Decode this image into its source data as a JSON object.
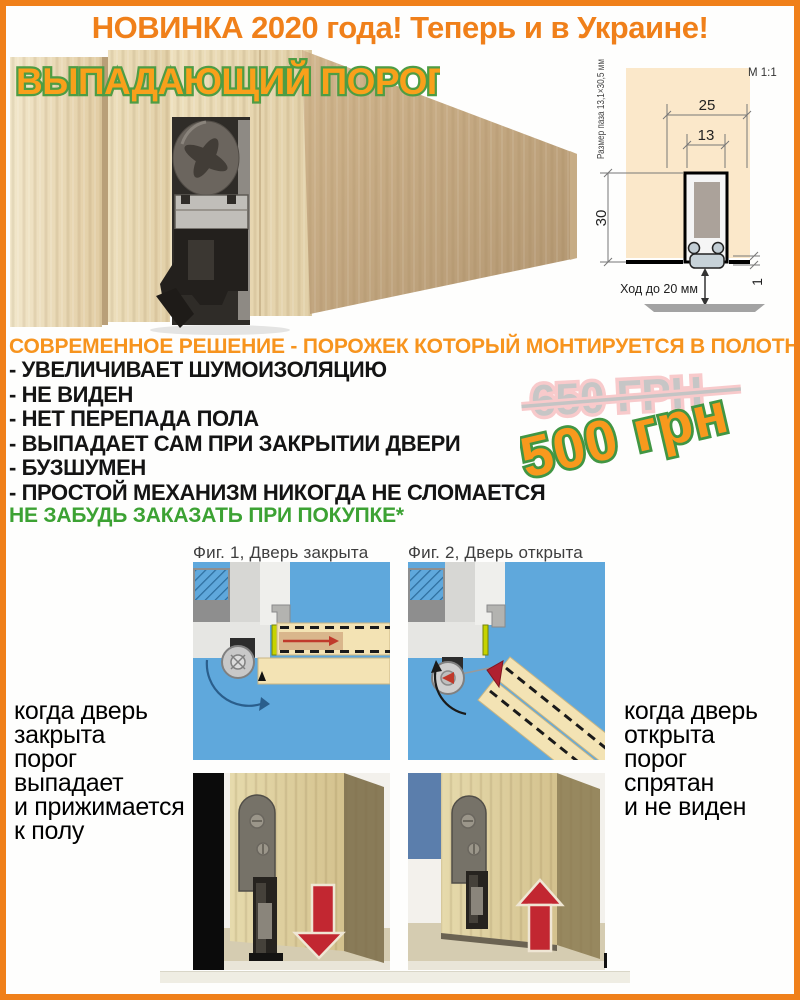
{
  "banner": {
    "text": "НОВИНКА 2020 года! Теперь и в Украине!"
  },
  "product": {
    "title": "ВЫПАДАЮЩИЙ ПОРОГ"
  },
  "diagram": {
    "scale": "М 1:1",
    "groove_size": "Размер паза 13,1×30,5 мм",
    "width_outer_mm": "25",
    "width_inner_mm": "13",
    "height_mm": "30",
    "gap_mm": "1",
    "travel": "Ход до 20 мм"
  },
  "promo": {
    "headline": "СОВРЕМЕННОЕ РЕШЕНИЕ - ПОРОЖЕК КОТОРЫЙ МОНТИРУЕТСЯ В ПОЛОТНО!",
    "features": [
      "- УВЕЛИЧИВАЕТ ШУМОИЗОЛЯЦИЮ",
      "- НЕ ВИДЕН",
      "- НЕТ ПЕРЕПАДА ПОЛА",
      "- ВЫПАДАЕТ САМ ПРИ ЗАКРЫТИИ ДВЕРИ",
      "- БУЗШУМЕН",
      "- ПРОСТОЙ МЕХАНИЗМ НИКОГДА НЕ СЛОМАЕТСЯ"
    ],
    "reminder": "НЕ ЗАБУДЬ ЗАКАЗАТЬ ПРИ ПОКУПКЕ*",
    "price_old": "650 ГРН",
    "price_new": "500 грн"
  },
  "figures": {
    "fig1": {
      "label": "Фиг. 1, Дверь закрыта",
      "caption_lines": [
        "когда дверь",
        "закрыта",
        "порог",
        "выпадает",
        "и прижимается",
        "к полу"
      ]
    },
    "fig2": {
      "label": "Фиг. 2, Дверь открыта",
      "caption_lines": [
        "когда дверь",
        "открыта",
        "порог",
        "спрятан",
        "и не виден"
      ]
    }
  },
  "colors": {
    "accent_orange": "#F0801A",
    "title_fill": "#F9A01B",
    "outline_green": "#4E9D44",
    "reminder_green": "#3CA233",
    "price_new_fill": "#F8991D",
    "price_old_gray": "#C6C6C6",
    "price_old_pink": "#F8CACB",
    "figure_blue": "#5FA8DC",
    "arrow_red": "#C22731",
    "diagram_peach": "#FBE8CA"
  }
}
